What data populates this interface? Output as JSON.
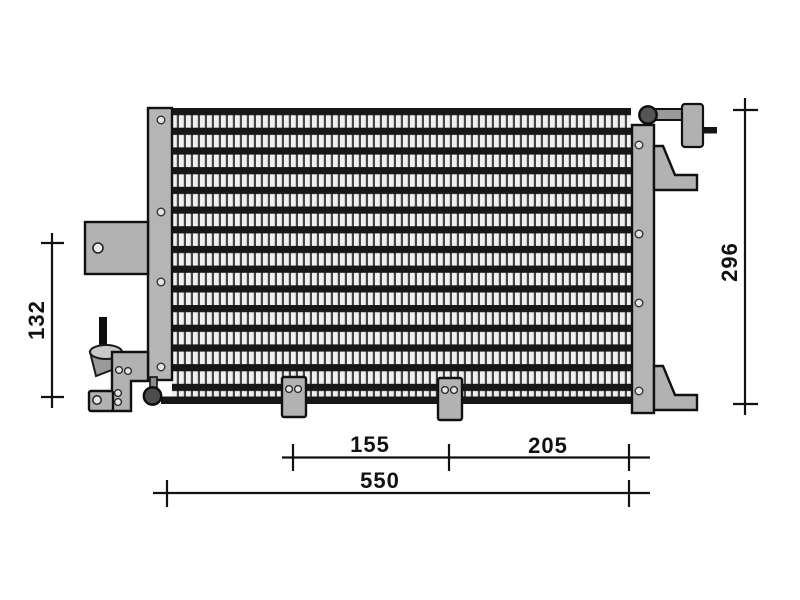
{
  "drawing": {
    "kind": "technical-drawing",
    "dimensions": {
      "left_vertical": "132",
      "right_vertical": "296",
      "bottom_left_span": "155",
      "bottom_right_span": "205",
      "bottom_total": "550"
    },
    "colors": {
      "background": "#ffffff",
      "line": "#111111",
      "metal_light": "#b5b5b5",
      "metal_mid": "#9a9a9a",
      "metal_dark": "#555555",
      "tube_dark": "#171717",
      "fin_light": "#f0f0f0"
    }
  }
}
